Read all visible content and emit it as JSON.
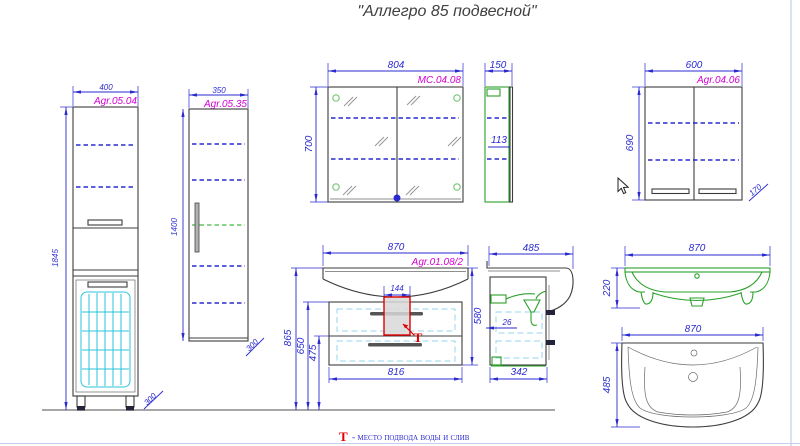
{
  "title": "\"Аллегро 85 подвесной\"",
  "legend": {
    "symbol": "Т",
    "text": "- место подвода воды и слив"
  },
  "colors": {
    "dimension": "#2a2ad0",
    "label": "#d400d4",
    "outline": "#3c3c3c",
    "green": "#2aa02a",
    "cyan": "#2cc6d8",
    "red": "#e00000",
    "floor": "#8a8a8a",
    "frame": "#b9c4ea"
  },
  "views": {
    "tall_cabinet": {
      "code": "Agr.05.04",
      "width": "400",
      "height": "1845",
      "depth": "300"
    },
    "slim_cabinet": {
      "code": "Agr.05.35",
      "width": "350",
      "height": "1400",
      "depth": "300"
    },
    "mirror_cabinet": {
      "code": "MC.04.08",
      "width": "804",
      "height": "700",
      "depth": "150",
      "side_inner": "113"
    },
    "wall_cabinet": {
      "code": "Agr.04.06",
      "width": "600",
      "height": "690",
      "depth": "170"
    },
    "vanity": {
      "code": "Agr.01.08/2",
      "width": "870",
      "siphon_cutout": "144",
      "height_total": "865",
      "height_body": "650",
      "height_divider": "475",
      "inner_width": "816",
      "body_height": "580",
      "water_marker": "Т"
    },
    "vanity_side": {
      "depth": "485",
      "gap": "26",
      "body_depth": "342"
    },
    "washbasin_front": {
      "width": "870",
      "height": "220"
    },
    "washbasin_top": {
      "width": "870",
      "depth": "485"
    }
  }
}
